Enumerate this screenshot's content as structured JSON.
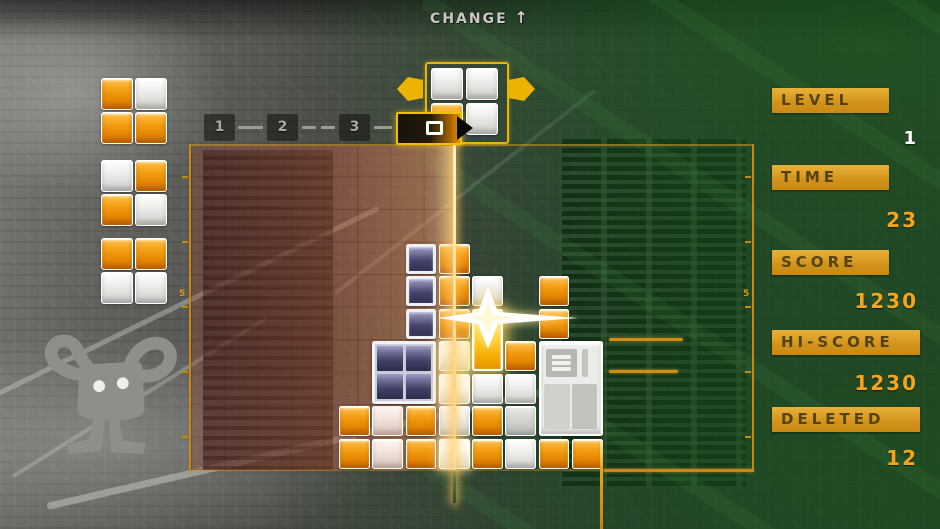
{
  "change_indicator": {
    "label": "CHANGE",
    "arrow": "↑"
  },
  "sequence": {
    "items": [
      "1",
      "2",
      "3"
    ],
    "current_glyph": "square-outline"
  },
  "field_rulers": {
    "left_label": "5",
    "right_label": "5"
  },
  "hud": {
    "stats": [
      {
        "label": "LEVEL",
        "value": "1",
        "value_color": "#ffffff"
      },
      {
        "label": "TIME",
        "value": "23",
        "value_color": "#f7a41d"
      },
      {
        "label": "SCORE",
        "value": "1230",
        "value_color": "#f7a41d"
      },
      {
        "label": "HI-SCORE",
        "value": "1230",
        "value_color": "#f7a41d"
      },
      {
        "label": "DELETED",
        "value": "12",
        "value_color": "#f7a41d"
      }
    ]
  },
  "colors": {
    "accent_orange": "#f7a41d",
    "bar_gold": "#d2921a",
    "frame_orange": "#c8870f",
    "block_orange": "#f29a10",
    "block_white": "#efefec",
    "block_navy": "#40406a",
    "block_gold_flash": "#ffc61e",
    "trail_pink": "#c85c42",
    "circuit_green": "#1c5e24"
  },
  "queue": {
    "pieces": [
      {
        "cells": [
          "orange",
          "white",
          "orange",
          "orange"
        ]
      },
      {
        "cells": [
          "white",
          "orange",
          "orange",
          "white"
        ]
      },
      {
        "cells": [
          "orange",
          "orange",
          "white",
          "white"
        ]
      }
    ]
  },
  "preview": {
    "cells": [
      "white",
      "white",
      "orange",
      "white"
    ]
  },
  "playfield": {
    "cols": 16,
    "rows": 10,
    "blocks": [
      {
        "c": 4,
        "r": 8,
        "w": 1,
        "h": 1,
        "t": "O"
      },
      {
        "c": 4,
        "r": 9,
        "w": 1,
        "h": 1,
        "t": "O"
      },
      {
        "c": 5,
        "r": 8,
        "w": 1,
        "h": 1,
        "t": "Wp"
      },
      {
        "c": 5,
        "r": 9,
        "w": 1,
        "h": 1,
        "t": "Wp"
      },
      {
        "c": 5,
        "r": 6,
        "w": 2,
        "h": 2,
        "t": "Nm"
      },
      {
        "c": 6,
        "r": 3,
        "w": 1,
        "h": 1,
        "t": "N"
      },
      {
        "c": 6,
        "r": 4,
        "w": 1,
        "h": 1,
        "t": "N"
      },
      {
        "c": 6,
        "r": 5,
        "w": 1,
        "h": 1,
        "t": "N"
      },
      {
        "c": 6,
        "r": 8,
        "w": 1,
        "h": 1,
        "t": "O"
      },
      {
        "c": 6,
        "r": 9,
        "w": 1,
        "h": 1,
        "t": "O"
      },
      {
        "c": 7,
        "r": 3,
        "w": 1,
        "h": 1,
        "t": "O"
      },
      {
        "c": 7,
        "r": 4,
        "w": 1,
        "h": 1,
        "t": "O"
      },
      {
        "c": 7,
        "r": 5,
        "w": 1,
        "h": 1,
        "t": "O"
      },
      {
        "c": 7,
        "r": 6,
        "w": 1,
        "h": 1,
        "t": "Wb"
      },
      {
        "c": 7,
        "r": 7,
        "w": 1,
        "h": 1,
        "t": "Wb"
      },
      {
        "c": 7,
        "r": 8,
        "w": 1,
        "h": 1,
        "t": "W"
      },
      {
        "c": 7,
        "r": 9,
        "w": 1,
        "h": 1,
        "t": "Wb"
      },
      {
        "c": 8,
        "r": 4,
        "w": 1,
        "h": 1,
        "t": "W"
      },
      {
        "c": 8,
        "r": 5,
        "w": 1,
        "h": 2,
        "t": "G"
      },
      {
        "c": 8,
        "r": 7,
        "w": 1,
        "h": 1,
        "t": "W"
      },
      {
        "c": 8,
        "r": 8,
        "w": 1,
        "h": 1,
        "t": "O"
      },
      {
        "c": 8,
        "r": 9,
        "w": 1,
        "h": 1,
        "t": "O"
      },
      {
        "c": 9,
        "r": 6,
        "w": 1,
        "h": 1,
        "t": "O"
      },
      {
        "c": 9,
        "r": 7,
        "w": 1,
        "h": 1,
        "t": "W"
      },
      {
        "c": 9,
        "r": 8,
        "w": 1,
        "h": 1,
        "t": "Wg"
      },
      {
        "c": 9,
        "r": 9,
        "w": 1,
        "h": 1,
        "t": "W"
      },
      {
        "c": 10,
        "r": 4,
        "w": 1,
        "h": 1,
        "t": "O"
      },
      {
        "c": 10,
        "r": 5,
        "w": 1,
        "h": 1,
        "t": "O"
      },
      {
        "c": 10,
        "r": 6,
        "w": 2,
        "h": 3,
        "t": "Wm"
      },
      {
        "c": 10,
        "r": 9,
        "w": 1,
        "h": 1,
        "t": "O"
      },
      {
        "c": 11,
        "r": 9,
        "w": 1,
        "h": 1,
        "t": "O"
      }
    ]
  }
}
